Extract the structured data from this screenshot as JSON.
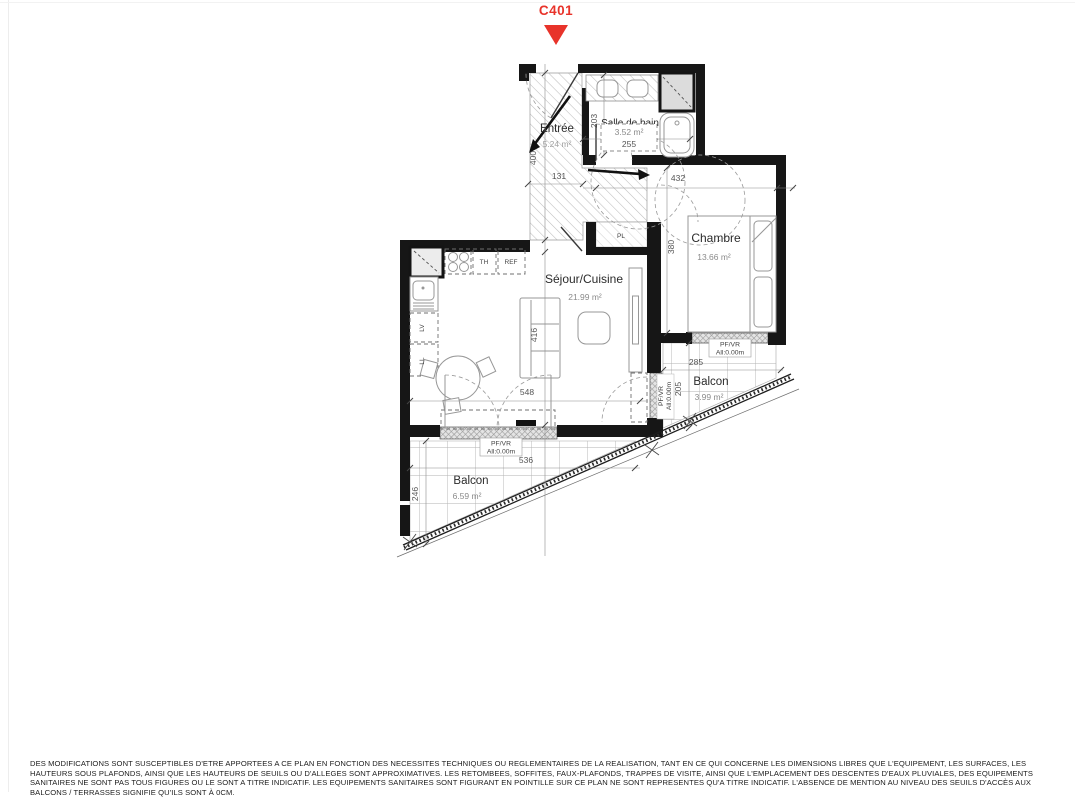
{
  "marker": {
    "label": "C401",
    "color": "#e8332a"
  },
  "rooms": {
    "entree": {
      "name": "Entrée",
      "area": "5.24 m²"
    },
    "bain": {
      "name": "Salle de bain",
      "area": "3.52 m²"
    },
    "chambre": {
      "name": "Chambre",
      "area": "13.66 m²"
    },
    "sejour": {
      "name": "Séjour/Cuisine",
      "area": "21.99 m²"
    },
    "balcon_e": {
      "name": "Balcon",
      "area": "3.99 m²"
    },
    "balcon_s": {
      "name": "Balcon",
      "area": "6.59 m²"
    }
  },
  "tags": {
    "placard": "PL",
    "th": "TH",
    "refrigerateur": "REF",
    "lave_vaisselle": "LV",
    "lave_linge": "LL"
  },
  "window_label": {
    "type": "PF/VR",
    "sill": "All:0.00m"
  },
  "dimensions": {
    "entree_len": "400",
    "entree_wid": "131",
    "bain_dep": "203",
    "bain_wid": "255",
    "chambre_wid": "432",
    "chambre_dep": "380",
    "sejour_dep": "416",
    "sejour_wid": "548",
    "balcon_s_wid": "536",
    "balcon_s_dep": "246",
    "balcon_e_wid": "285",
    "balcon_e_dep": "205"
  },
  "disclaimer": {
    "lines": [
      "DES MODIFICATIONS SONT SUSCEPTIBLES D'ETRE APPORTEES A CE PLAN EN FONCTION DES NECESSITES TECHNIQUES OU REGLEMENTAIRES DE LA REALISATION, TANT EN CE QUI CONCERNE LES DIMENSIONS LIBRES QUE L'EQUIPEMENT, LES SURFACES, LES",
      "HAUTEURS SOUS PLAFONDS, AINSI QUE LES HAUTEURS DE SEUILS OU D'ALLEGES SONT APPROXIMATIVES. LES RETOMBEES, SOFFITES, FAUX-PLAFONDS, TRAPPES DE VISITE, AINSI QUE L'EMPLACEMENT DES DESCENTES D'EAUX PLUVIALES, DES EQUIPEMENTS",
      "SANITAIRES NE SONT PAS TOUS FIGURES OU LE SONT A TITRE INDICATIF. LES EQUIPEMENTS SANITAIRES SONT FIGURANT EN POINTILLE SUR CE PLAN NE SONT REPRESENTES QU'A TITRE INDICATIF. L'ABSENCE DE MENTION AU NIVEAU DES SEUILS D'ACCÈS AUX",
      "BALCONS / TERRASSES SIGNIFIE QU'ILS SONT À 0CM."
    ]
  }
}
